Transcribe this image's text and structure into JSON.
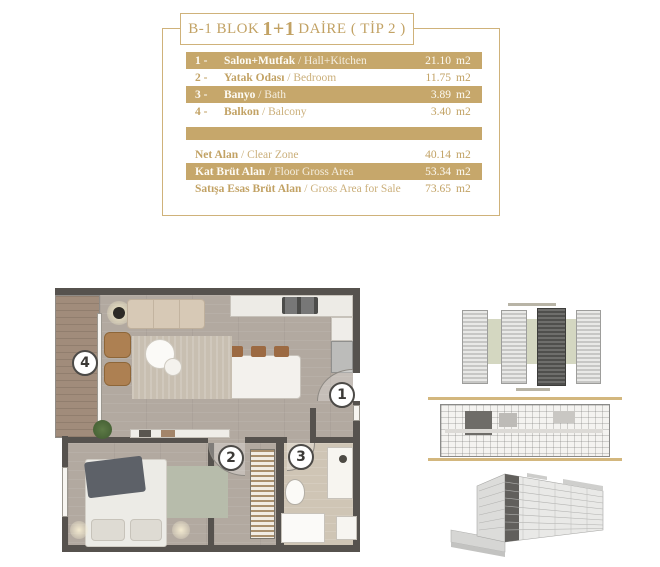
{
  "title": {
    "prefix": "B-1 BLOK",
    "unit": "1+1",
    "suffix": "DAİRE ( TİP 2 )"
  },
  "table": {
    "rows": [
      {
        "num": "1 -",
        "tr": "Salon+Mutfak",
        "en": " / Hall+Kitchen",
        "value": "21.10",
        "unit": "m2"
      },
      {
        "num": "2 -",
        "tr": "Yatak Odası",
        "en": " / Bedroom",
        "value": "11.75",
        "unit": "m2"
      },
      {
        "num": "3 -",
        "tr": "Banyo",
        "en": " / Bath",
        "value": "3.89",
        "unit": "m2"
      },
      {
        "num": "4 -",
        "tr": "Balkon",
        "en": " / Balcony",
        "value": "3.40",
        "unit": "m2"
      }
    ],
    "summary": [
      {
        "tr": "Net Alan",
        "en": " / Clear Zone",
        "value": "40.14",
        "unit": "m2"
      },
      {
        "tr": "Kat Brüt Alan",
        "en": " / Floor Gross Area",
        "value": "53.34",
        "unit": "m2"
      },
      {
        "tr": "Satışa Esas Brüt Alan",
        "en": " / Gross Area for Sale",
        "value": "73.65",
        "unit": "m2"
      }
    ]
  },
  "floorplan": {
    "badges": [
      "1",
      "2",
      "3",
      "4"
    ]
  },
  "colors": {
    "gold": "#c6a76b",
    "gold_text": "#c2a264",
    "wall": "#56524e",
    "living_floor": "#b2a9a0",
    "balcony_floor": "#a18c7b",
    "bathroom_floor": "#cfc5b5"
  }
}
